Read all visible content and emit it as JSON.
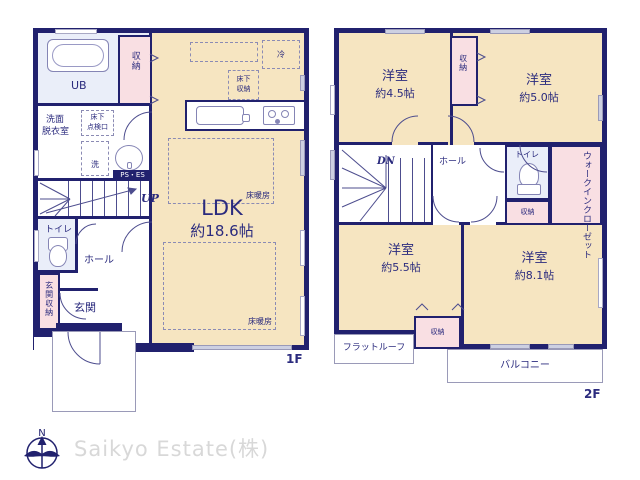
{
  "colors": {
    "wall": "#21216e",
    "room_fill": "#f6e5c1",
    "closet_fill": "#f9dfe3",
    "text": "#2b2b7e",
    "logo_text": "#d8d8d8"
  },
  "floor1": {
    "label": "1F",
    "ub": "UB",
    "storage_top": "収納",
    "senmen1": "洗面",
    "senmen2": "脱衣室",
    "tenken1": "床下",
    "tenken2": "点検口",
    "washer": "洗",
    "ps_es": "PS・ES",
    "up": "UP",
    "toilet": "トイレ",
    "hall": "ホール",
    "genkan_storage": "玄関収納",
    "genkan": "玄関",
    "fridge": "冷",
    "underfloor1": "床下",
    "underfloor2": "収納",
    "ldk": "LDK",
    "ldk_size": "約18.6帖",
    "heating": "床暖房"
  },
  "floor2": {
    "label": "2F",
    "room45": "洋室",
    "room45_size": "約4.5帖",
    "room50": "洋室",
    "room50_size": "約5.0帖",
    "room55": "洋室",
    "room55_size": "約5.5帖",
    "room81": "洋室",
    "room81_size": "約8.1帖",
    "storage_top": "収納",
    "dn": "DN",
    "hall": "ホール",
    "toilet": "トイレ",
    "wic": "ウォークインクローゼット",
    "storage_mid": "収納",
    "storage_bottom": "収納",
    "flat_roof": "フラットルーフ",
    "balcony": "バルコニー"
  },
  "footer": {
    "company": "Saikyo Estate(株)",
    "compass_north": "N"
  }
}
